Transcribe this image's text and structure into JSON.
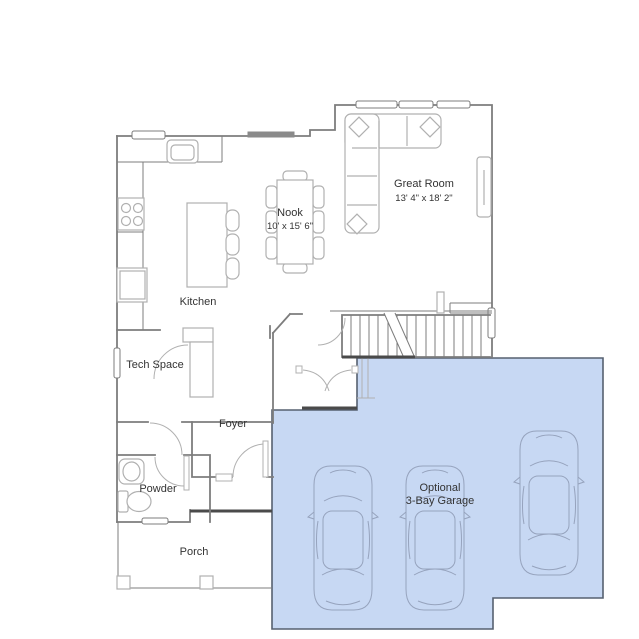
{
  "floorplan": {
    "rooms": {
      "nook": {
        "name": "Nook",
        "dimensions": "10' x 15' 6\""
      },
      "great_room": {
        "name": "Great Room",
        "dimensions": "13' 4\" x 18' 2\""
      },
      "kitchen": {
        "name": "Kitchen"
      },
      "tech_space": {
        "name": "Tech Space"
      },
      "foyer": {
        "name": "Foyer"
      },
      "powder": {
        "name": "Powder"
      },
      "porch": {
        "name": "Porch"
      },
      "garage": {
        "name_line1": "Optional",
        "name_line2": "3-Bay Garage",
        "car_count": 3
      }
    },
    "colors": {
      "background": "#ffffff",
      "garage_fill": "#c7d8f3",
      "garage_border": "#566070",
      "wall": "#7d7d7d",
      "wall_dark": "#4a4a4a",
      "furniture": "#b0b0b0",
      "car_outline": "#96a3bd",
      "text": "#333333",
      "window_fill": "#8a8a8a"
    }
  }
}
